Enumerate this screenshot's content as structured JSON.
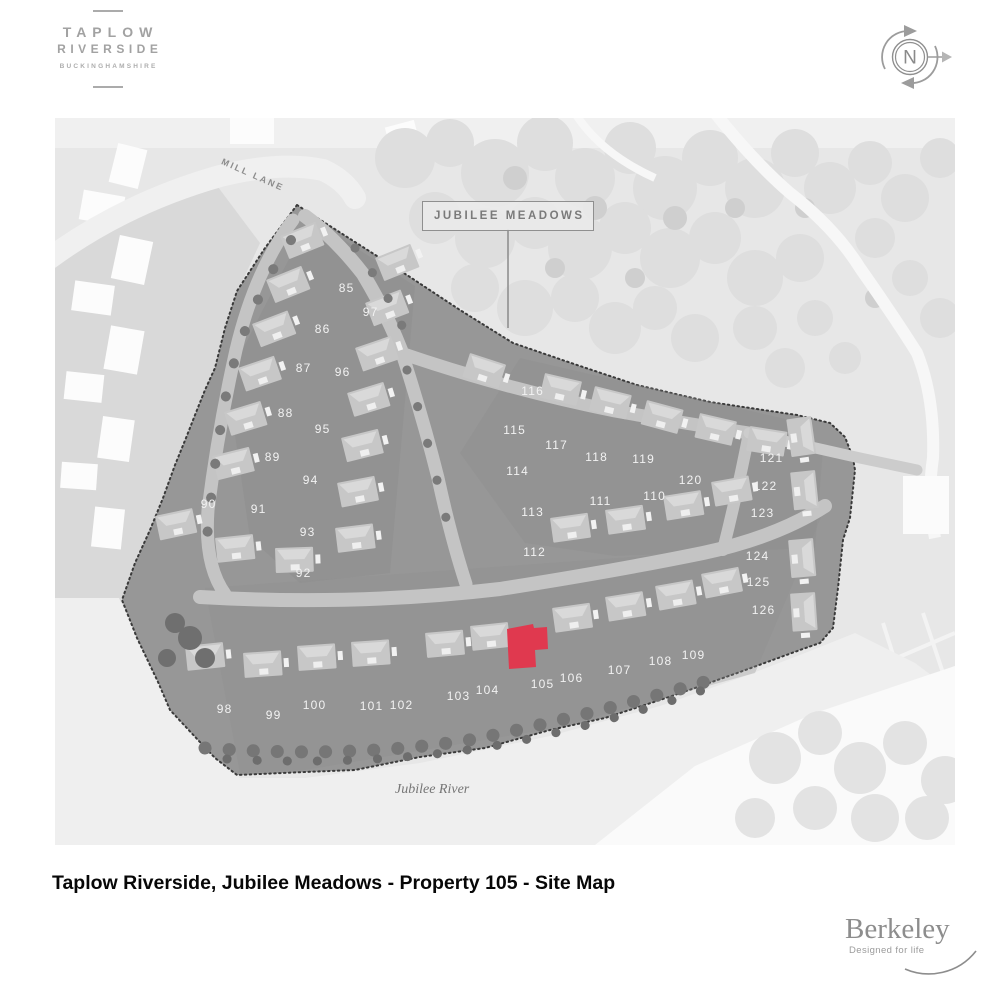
{
  "brand": {
    "title": "TAPLOW",
    "subtitle": "RIVERSIDE",
    "region": "BUCKINGHAMSHIRE"
  },
  "compass": {
    "label": "N"
  },
  "map": {
    "area_label": "JUBILEE MEADOWS",
    "road_label": "MILL LANE",
    "river_label": "Jubilee River",
    "highlighted_plot": "105",
    "highlight_color": "#e0394f",
    "plots": [
      {
        "n": "85",
        "x": 291,
        "y": 170
      },
      {
        "n": "86",
        "x": 267,
        "y": 211
      },
      {
        "n": "87",
        "x": 248,
        "y": 250
      },
      {
        "n": "88",
        "x": 230,
        "y": 295
      },
      {
        "n": "89",
        "x": 217,
        "y": 339
      },
      {
        "n": "90",
        "x": 153,
        "y": 386
      },
      {
        "n": "91",
        "x": 203,
        "y": 391
      },
      {
        "n": "92",
        "x": 248,
        "y": 455
      },
      {
        "n": "93",
        "x": 252,
        "y": 414
      },
      {
        "n": "94",
        "x": 255,
        "y": 362
      },
      {
        "n": "95",
        "x": 267,
        "y": 311
      },
      {
        "n": "96",
        "x": 287,
        "y": 254
      },
      {
        "n": "97",
        "x": 315,
        "y": 194
      },
      {
        "n": "98",
        "x": 169,
        "y": 591
      },
      {
        "n": "99",
        "x": 218,
        "y": 597
      },
      {
        "n": "100",
        "x": 259,
        "y": 587
      },
      {
        "n": "101",
        "x": 316,
        "y": 588
      },
      {
        "n": "102",
        "x": 346,
        "y": 587
      },
      {
        "n": "103",
        "x": 403,
        "y": 578
      },
      {
        "n": "104",
        "x": 432,
        "y": 572
      },
      {
        "n": "105",
        "x": 487,
        "y": 566
      },
      {
        "n": "106",
        "x": 516,
        "y": 560
      },
      {
        "n": "107",
        "x": 564,
        "y": 552
      },
      {
        "n": "108",
        "x": 605,
        "y": 543
      },
      {
        "n": "109",
        "x": 638,
        "y": 537
      },
      {
        "n": "110",
        "x": 599,
        "y": 378
      },
      {
        "n": "111",
        "x": 545,
        "y": 383
      },
      {
        "n": "112",
        "x": 479,
        "y": 434
      },
      {
        "n": "113",
        "x": 477,
        "y": 394
      },
      {
        "n": "114",
        "x": 462,
        "y": 353
      },
      {
        "n": "115",
        "x": 459,
        "y": 312
      },
      {
        "n": "116",
        "x": 477,
        "y": 273
      },
      {
        "n": "117",
        "x": 501,
        "y": 327
      },
      {
        "n": "118",
        "x": 541,
        "y": 339
      },
      {
        "n": "119",
        "x": 588,
        "y": 341
      },
      {
        "n": "120",
        "x": 635,
        "y": 362
      },
      {
        "n": "121",
        "x": 716,
        "y": 340
      },
      {
        "n": "122",
        "x": 710,
        "y": 368
      },
      {
        "n": "123",
        "x": 707,
        "y": 395
      },
      {
        "n": "124",
        "x": 702,
        "y": 438
      },
      {
        "n": "125",
        "x": 703,
        "y": 464
      },
      {
        "n": "126",
        "x": 708,
        "y": 492
      }
    ]
  },
  "caption": "Taplow Riverside, Jubilee Meadows - Property 105 - Site Map",
  "footer": {
    "logo": "Berkeley",
    "tagline": "Designed for life"
  }
}
